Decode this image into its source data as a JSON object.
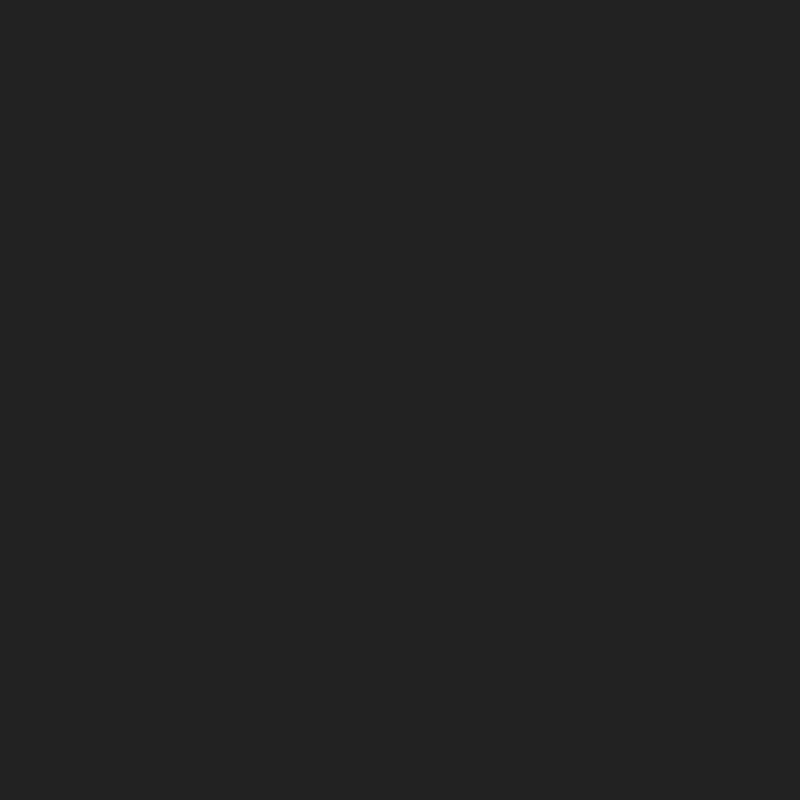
{
  "collage": {
    "grid": "2x2",
    "panels": [
      {
        "name": "rug-terracotta-red-beige-border",
        "style": "floral",
        "alt": "Living room with terracotta red oriental rug, beige floral border and cream medallion",
        "carpet": {
          "edge": "#2a2118",
          "guard": "#eee4c8",
          "border": "#ebe1c4",
          "borderDot": "#b98f62",
          "borderDot2": "#64828a",
          "line": "#3a2e1e",
          "band2": "#b2a87a",
          "band2Dot": "#e4d6ae",
          "line2": "#3a2e1e",
          "field": "#b55845",
          "vine": "#c7a469",
          "accentA": "#e9d8b4",
          "accentB": "#4f6c64",
          "accentC": "#f0e8d6",
          "med1": "#efe7d3",
          "med2": "#3f5f58",
          "med3": "#c9a45f",
          "med4": "#e2bec7",
          "med5": "#ba5c4c"
        }
      },
      {
        "name": "rug-cream-burgundy-border",
        "style": "diamond",
        "alt": "Living room with ivory oriental rug, dark burgundy border and diamond medallion",
        "carpet": {
          "edge": "#4a1c10",
          "guard": "#e8d5b0",
          "border": "#6e2c1a",
          "borderDot": "#d3a164",
          "borderDot2": "#e8d0a2",
          "line": "#ecdfc0",
          "band2": "#e9dcba",
          "band2Dot": "#b2543a",
          "line2": "#9c4630",
          "field": "#eee2c4",
          "vine": "#b2543a",
          "accentA": "#b34c32",
          "accentB": "#74823f",
          "accentC": "#dba88b",
          "med1": "#5e2416",
          "med2": "#ead7ae",
          "med3": "#cb9252",
          "med4": "#7c3b22",
          "med5": "#8c9c54"
        }
      },
      {
        "name": "rug-black-purple-gold",
        "style": "quatrefoil",
        "alt": "Living room with black oriental rug, navy-purple border and mauve medallion with gold scrolls",
        "carpet": {
          "edge": "#151019",
          "guard": "#7c5692",
          "border": "#2d2b56",
          "borderDot": "#c28c4e",
          "borderDot2": "#c06c9e",
          "line": "#c9974f",
          "band2": "#161228",
          "band2Dot": "#8c58b2",
          "line2": "#c9974f",
          "field": "#0d0a0f",
          "vine": "#c28c4e",
          "accentA": "#b74a9c",
          "accentB": "#d89c5e",
          "accentC": "#7c4ea2",
          "med1": "#a9649b",
          "med2": "#c9974f",
          "med3": "#d9a55b",
          "med4": "#3b3672",
          "med5": "#d9b16b"
        }
      },
      {
        "name": "rug-red-circular-medallion",
        "style": "rings",
        "alt": "Living room with deep red oriental rug, cream border, salmon inner band and circular ring medallion",
        "carpet": {
          "edge": "#7e1620",
          "guard": "#a62432",
          "border": "#ecd9c0",
          "borderDot": "#c4607a",
          "borderDot2": "#ac3c4c",
          "line": "#a62432",
          "band2": "#d8917c",
          "band2Dot": "#f0dcc8",
          "line2": "#edd9bd",
          "field": "#8e1c26",
          "vine": "#d8a090",
          "accentA": "#ecccb0",
          "accentB": "#c2505c",
          "accentC": "#f0e0d0",
          "med1": "#ecd4b4",
          "med2": "#8e1c26",
          "med3": "#d08a8a",
          "med4": "#c44a52",
          "med5": "#f2e4cc"
        }
      }
    ]
  },
  "room": {
    "wall": "#98926e",
    "wallDark": "#837c5b",
    "wallLight": "#a9a17c",
    "ceilingWedge": "#e7dfc4",
    "grayPanel": "#a6a6a2",
    "grayPanelDark": "#5e5e5a",
    "branch": "#35302a",
    "molding": "#eae8de",
    "mirrorGlass": "#cfdfe9",
    "mirrorStripe": "#a3c1d4",
    "mirrorFrame": "#eceae0",
    "candelabra": "#6a4416",
    "candle": "#6b4a1c",
    "figurine": "#f2f1ea",
    "fireplace": "#f1f0ea",
    "fireplaceShade": "#d9d7cd",
    "firebox": "#1c1006",
    "fire1": "#ff7d1f",
    "fire2": "#ffd24a",
    "cabinet": "#f0efe9",
    "cabinetLine": "#cfccc2",
    "windowGlass": "#fafbf8",
    "windowFrame": "#e4e2da",
    "glassTint": "#eef3f0",
    "curtain": "#c2ad88",
    "curtainShade": "#a68f68",
    "tieback": "#b09a74",
    "floor": "#ddd0a6",
    "grout": "#bfae84",
    "inlay": "#6b4a2a",
    "inlaySq": "#241a10",
    "runner": "#cdd08e",
    "runnerLine": "#9aa050",
    "runnerEdge": "#efece0",
    "chairFab": "#5f6688",
    "chairFabLight": "#9aa0ba",
    "chairFrame": "#e9e9ec",
    "sofaLight": "#b4b4b8",
    "sofaMid": "#93939a",
    "sofaDark": "#5e5e63",
    "sofaBack": "#84848a",
    "sofaSeam": "#7e7e84",
    "pillowWhite": "#f4f3ef",
    "pillowBlue": "#6a739c",
    "lampShade": "#d9c38c",
    "lampShadeDark": "#b89c64",
    "lampBase": "#ece6d4",
    "table": "#e6e6e9",
    "tableSide": "#c8c8cd",
    "tableLeg": "#9a9aa0"
  }
}
